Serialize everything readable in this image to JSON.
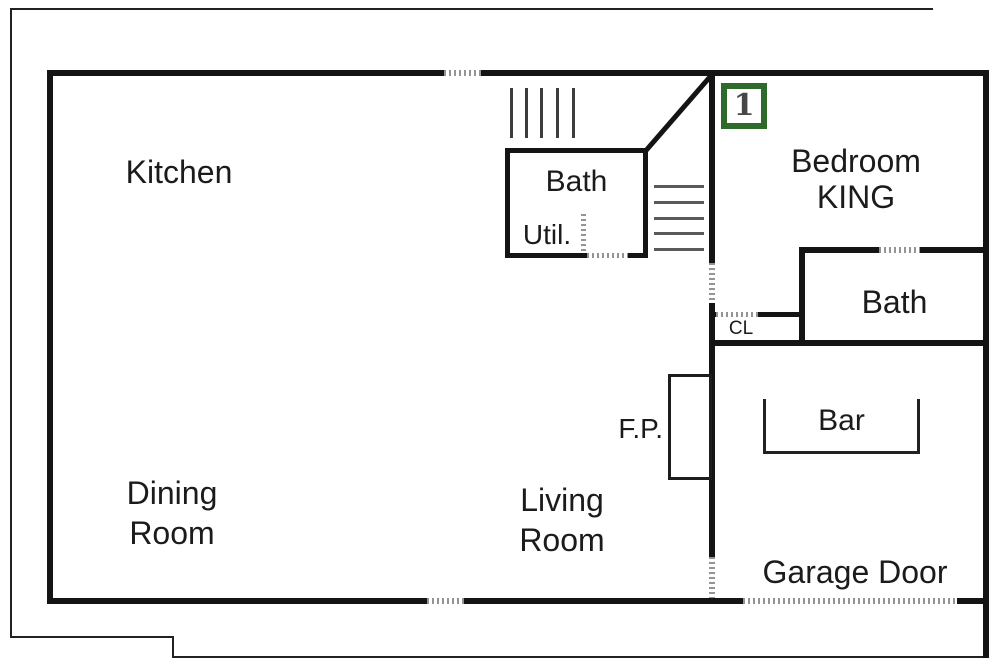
{
  "badge": {
    "number": "1",
    "border_color": "#2e6b2b"
  },
  "labels": {
    "kitchen": "Kitchen",
    "bath_middle": "Bath",
    "util": "Util.",
    "bedroom": {
      "line1": "Bedroom",
      "line2": "KING"
    },
    "bath_right": "Bath",
    "closet": "CL",
    "fireplace": "F.P.",
    "bar": "Bar",
    "dining": {
      "line1": "Dining",
      "line2": "Room"
    },
    "living": {
      "line1": "Living",
      "line2": "Room"
    },
    "garage_door": "Garage Door"
  },
  "colors": {
    "wall": "#141414",
    "outer_border": "#222222",
    "door_window_dash": "#949494",
    "badge_green": "#2e6b2b",
    "text": "#1b1b1b",
    "background": "#ffffff"
  },
  "legend_note_icons": {
    "stairs_hatch": "stairs-hatch",
    "door_opening": "dashed-opening",
    "window": "dashed-window"
  }
}
